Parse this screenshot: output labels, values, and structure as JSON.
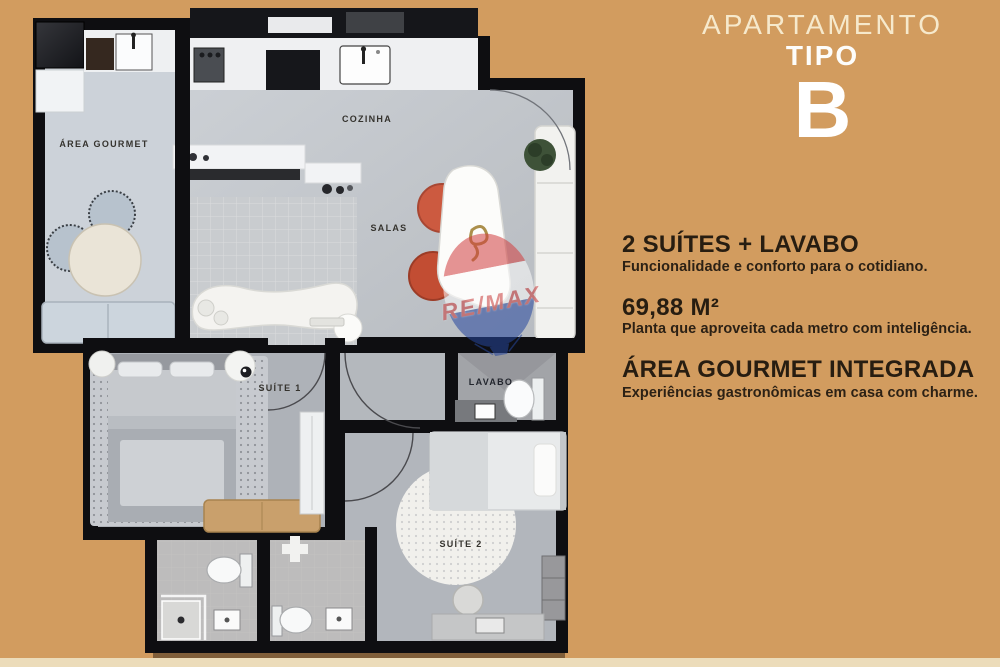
{
  "background": {
    "color": "#d29c5f",
    "bottom_strip_color": "#ecdcba"
  },
  "panel": {
    "title_line1": "APARTAMENTO",
    "title_line2": "TIPO",
    "title_line3": "B",
    "features": [
      {
        "heading": "2 SUÍTES + LAVABO",
        "description": "Funcionalidade e conforto para o cotidiano."
      },
      {
        "heading": "69,88 M²",
        "description": "Planta que aproveita cada metro com inteligência."
      },
      {
        "heading": "ÁREA GOURMET INTEGRADA",
        "description": "Experiências gastronômicas em casa com charme."
      }
    ],
    "text_color": "#271d11",
    "title_cream_color": "#f6e9cc",
    "title_white_color": "#ffffff"
  },
  "floorplan": {
    "rooms": [
      {
        "id": "area-gourmet",
        "label": "ÁREA GOURMET"
      },
      {
        "id": "cozinha",
        "label": "COZINHA"
      },
      {
        "id": "salas",
        "label": "SALAS"
      },
      {
        "id": "suite-1",
        "label": "SUÍTE 1"
      },
      {
        "id": "lavabo",
        "label": "LAVABO"
      },
      {
        "id": "suite-2",
        "label": "SUÍTE 2"
      }
    ],
    "watermark": "RE/MAX",
    "wall_color": "#0e0e11",
    "floor_color": "#c6cacf",
    "accent_chair_color": "#cc5a40",
    "wood_color": "#c9a06c"
  }
}
